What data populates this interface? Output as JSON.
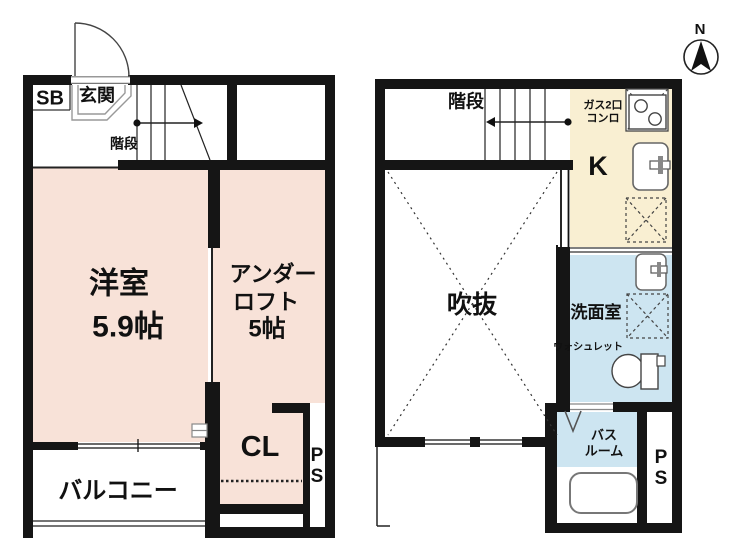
{
  "colors": {
    "wall": "#151515",
    "room_pink": "#f8e2d8",
    "kitchen_cream": "#f9efd2",
    "wet_area_blue": "#cde5f1"
  },
  "floor1": {
    "labels": {
      "shoe_box": "SB",
      "entrance": "玄関",
      "stairs": "階段",
      "western_room": "洋室",
      "western_room_size": "5.9帖",
      "under_loft_line1": "アンダー",
      "under_loft_line2": "ロフト",
      "under_loft_size": "5帖",
      "closet": "CL",
      "pipe_space_line1": "P",
      "pipe_space_line2": "S",
      "balcony": "バルコニー"
    }
  },
  "floor2": {
    "labels": {
      "stairs": "階段",
      "gas_stove_line1": "ガス2口",
      "gas_stove_line2": "コンロ",
      "kitchen": "K",
      "void": "吹抜",
      "washroom": "洗面室",
      "washlet": "ウォシュレット",
      "bathroom_line1": "バス",
      "bathroom_line2": "ルーム",
      "pipe_space_line1": "P",
      "pipe_space_line2": "S"
    }
  },
  "compass": {
    "north": "N"
  }
}
